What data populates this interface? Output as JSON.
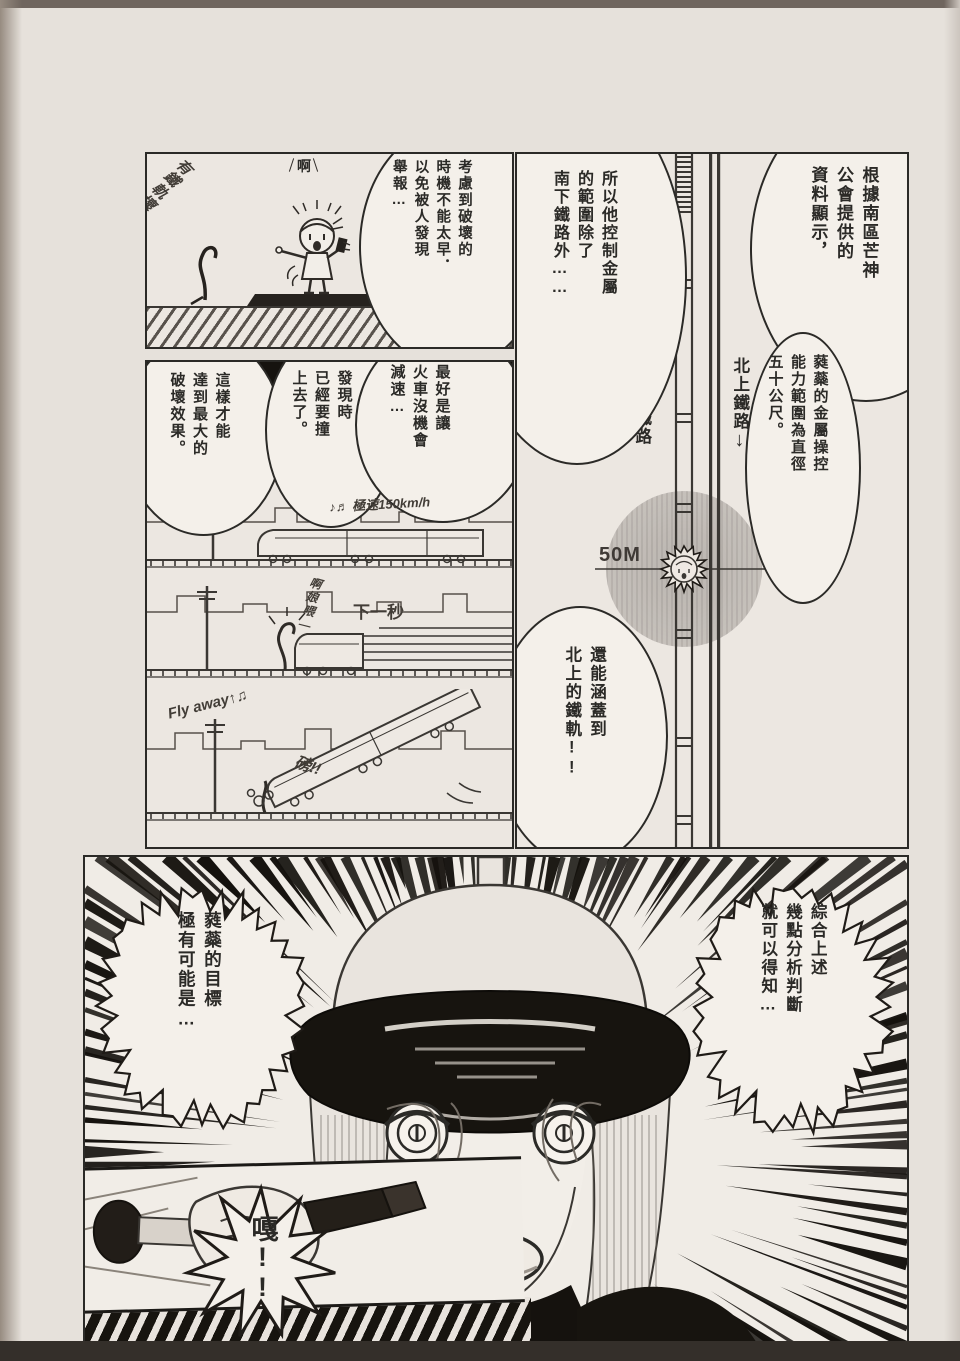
{
  "page": {
    "paper_color": "#e6e1db",
    "ink_color": "#2b2a27"
  },
  "icons": {
    "arrow_up": "↑",
    "arrow_down": "↓"
  },
  "panel_survey": {
    "handwritten_note": "有鐵軌壞了",
    "exclaim": "啊",
    "speech": "考慮到破壞的\n時機不能太早．\n以免被人發現\n舉報…"
  },
  "panel_plan": {
    "speech_right": "最好是讓\n火車沒機會\n減速…",
    "speech_middle": "發現時\n已經要撞\n上去了。",
    "speech_left": "這樣才能\n達到最大的\n破壞效果。",
    "note_speed": "♪♬ 極速150km/h",
    "caption_next_second": "下一秒",
    "sfx_scream": "啊娘喂—",
    "sfx_fly_away": "Fly away↑♫",
    "sfx_bang": "磅!!"
  },
  "panel_map": {
    "speech_top_right": "根據南區芒神\n公會提供的\n資料顯示，",
    "speech_right": "蕤蘂的金屬操控\n能力範圍為直徑\n五十公尺。",
    "speech_left": "所以他控制金屬\n的範圍除了\n南下鐵路外……",
    "speech_bottom": "還能涵蓋到\n北上的鐵軌!!",
    "label_south_line": "南下鐵路",
    "label_north_line": "北上鐵路",
    "label_radius": "50M"
  },
  "panel_reveal": {
    "speech_right": "綜合上述\n幾點分析判斷\n就可以得知…",
    "speech_left": "蕤蘂的目標\n極有可能是…",
    "sfx_shout": "嘎!!"
  }
}
